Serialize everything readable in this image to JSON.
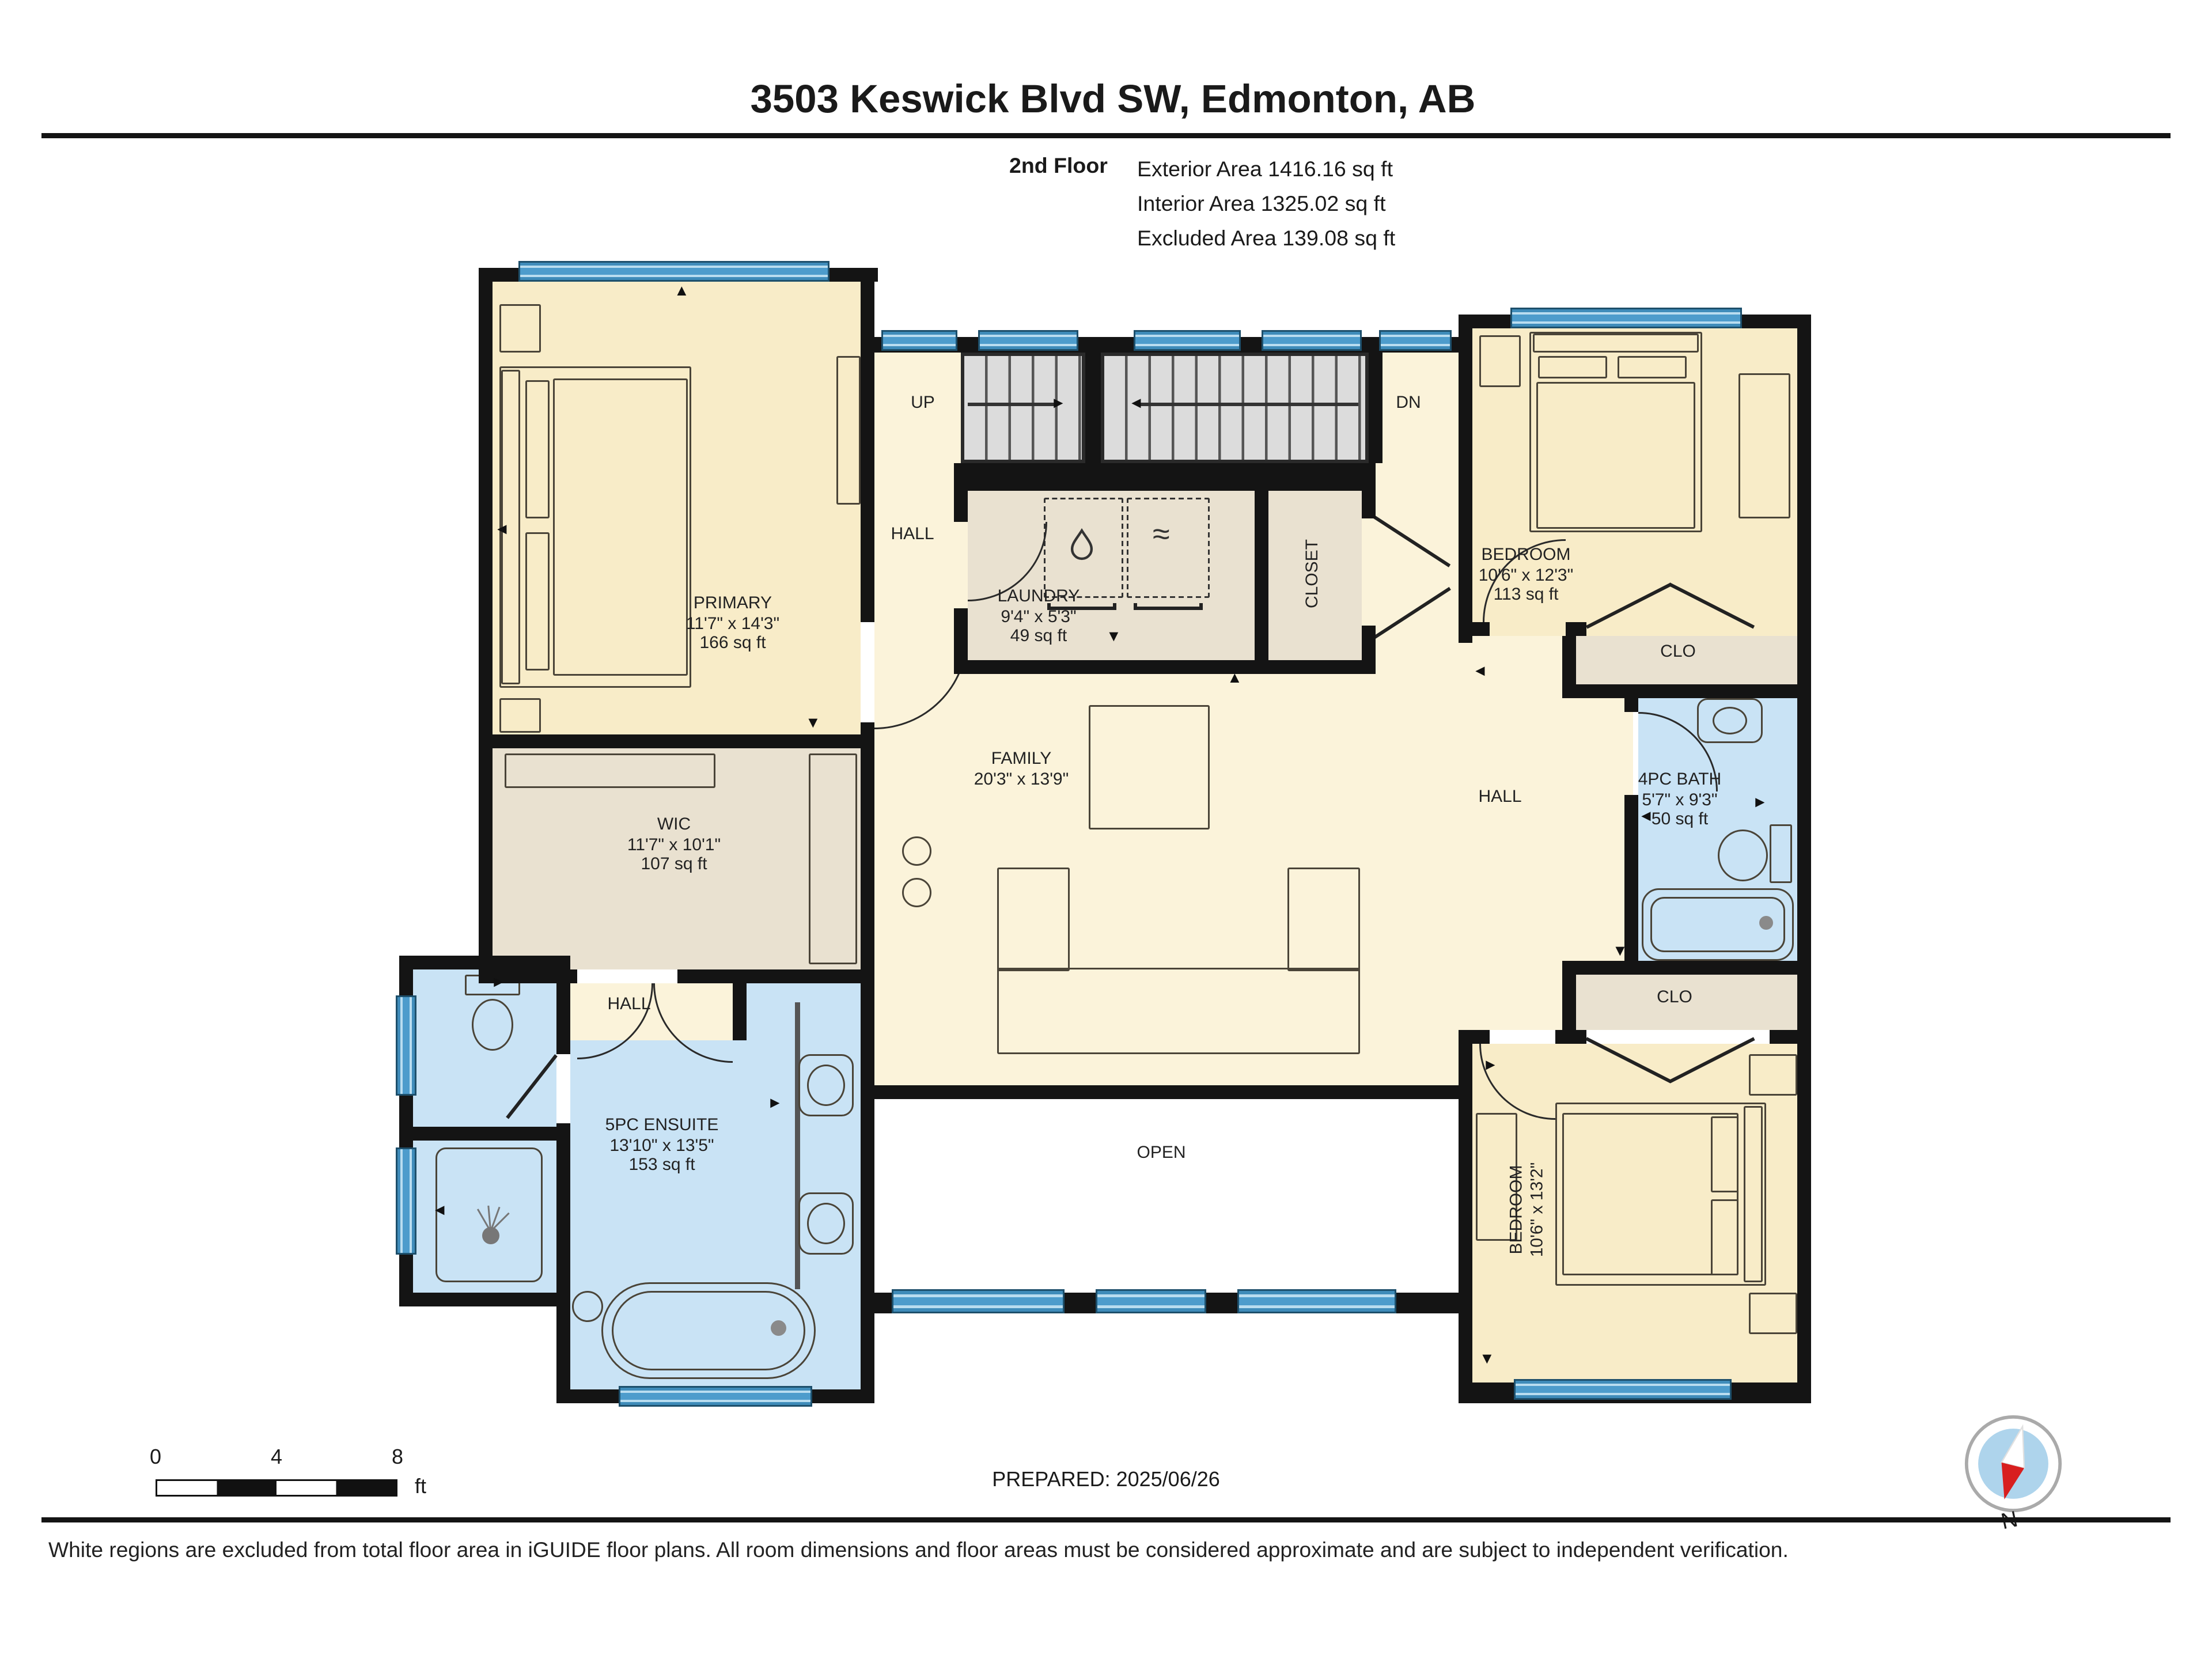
{
  "header": {
    "title": "3503 Keswick Blvd SW, Edmonton, AB",
    "floor_label": "2nd Floor",
    "area_lines": [
      "Exterior Area 1416.16 sq ft",
      "Interior Area 1325.02 sq ft",
      "Excluded Area 139.08 sq ft"
    ]
  },
  "rooms": {
    "primary": {
      "name": "PRIMARY",
      "dims": "11'7\" x 14'3\"",
      "area": "166 sq ft"
    },
    "wic": {
      "name": "WIC",
      "dims": "11'7\" x 10'1\"",
      "area": "107 sq ft"
    },
    "laundry": {
      "name": "LAUNDRY",
      "dims": "9'4\" x 5'3\"",
      "area": "49 sq ft"
    },
    "closet": {
      "name": "CLOSET"
    },
    "bedroom_top": {
      "name": "BEDROOM",
      "dims": "10'6\" x 12'3\"",
      "area": "113 sq ft"
    },
    "clo_top": {
      "name": "CLO"
    },
    "bath": {
      "name": "4PC BATH",
      "dims": "5'7\" x 9'3\"",
      "area": "50 sq ft"
    },
    "family": {
      "name": "FAMILY",
      "dims": "20'3\" x 13'9\""
    },
    "hall_left": {
      "name": "HALL"
    },
    "hall_right": {
      "name": "HALL"
    },
    "hall_small": {
      "name": "HALL"
    },
    "ensuite": {
      "name": "5PC ENSUITE",
      "dims": "13'10\" x 13'5\"",
      "area": "153 sq ft"
    },
    "clo_bottom": {
      "name": "CLO"
    },
    "bedroom_bottom": {
      "name": "BEDROOM",
      "dims": "10'6\" x 13'2\""
    },
    "open_area": {
      "name": "OPEN"
    },
    "stairs": {
      "up": "UP",
      "dn": "DN"
    }
  },
  "icons": {
    "up": "▲",
    "down": "▼",
    "left": "◄",
    "right": "►",
    "dryer": "≈"
  },
  "footer": {
    "scale": {
      "tick0": "0",
      "tick4": "4",
      "tick8": "8",
      "unit": "ft"
    },
    "prepared": "PREPARED: 2025/06/26",
    "compass": "N",
    "disclaimer": "White regions are excluded from total floor area in iGUIDE floor plans. All room dimensions and floor areas must be considered approximate and are subject to independent verification."
  },
  "colors": {
    "bedroom_fill": "#f8ecc8",
    "hall_fill": "#fbf3da",
    "storage_fill": "#e9e1d0",
    "bath_fill": "#c9e3f5",
    "window_blue": "#4d9ccc",
    "wall": "#141414",
    "stairs_fill": "#dedede"
  }
}
